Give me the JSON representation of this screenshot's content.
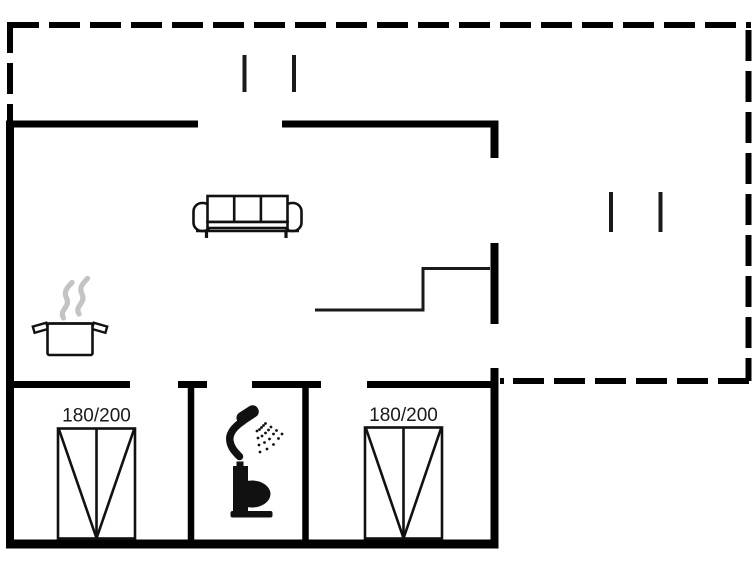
{
  "floor_plan": {
    "bed_left_label": "180/200",
    "bed_right_label": "180/200"
  },
  "colors": {
    "wall": "#000000",
    "icon": "#111111",
    "thin_line": "#1a1a1a",
    "steam": "#c3c3c3",
    "label_text": "#1a1a1a",
    "background": "#ffffff"
  },
  "icons": {
    "sofa": "sofa-icon",
    "cooking_pot": "cooking-pot-icon",
    "steam": "steam-icon",
    "shower": "shower-head-icon",
    "toilet": "toilet-icon",
    "bed_left": "double-bed-icon",
    "bed_right": "double-bed-icon",
    "window_marks": "window-mark-icon",
    "terrace_outline": "dashed-terrace-outline",
    "stairs": "step-line"
  }
}
